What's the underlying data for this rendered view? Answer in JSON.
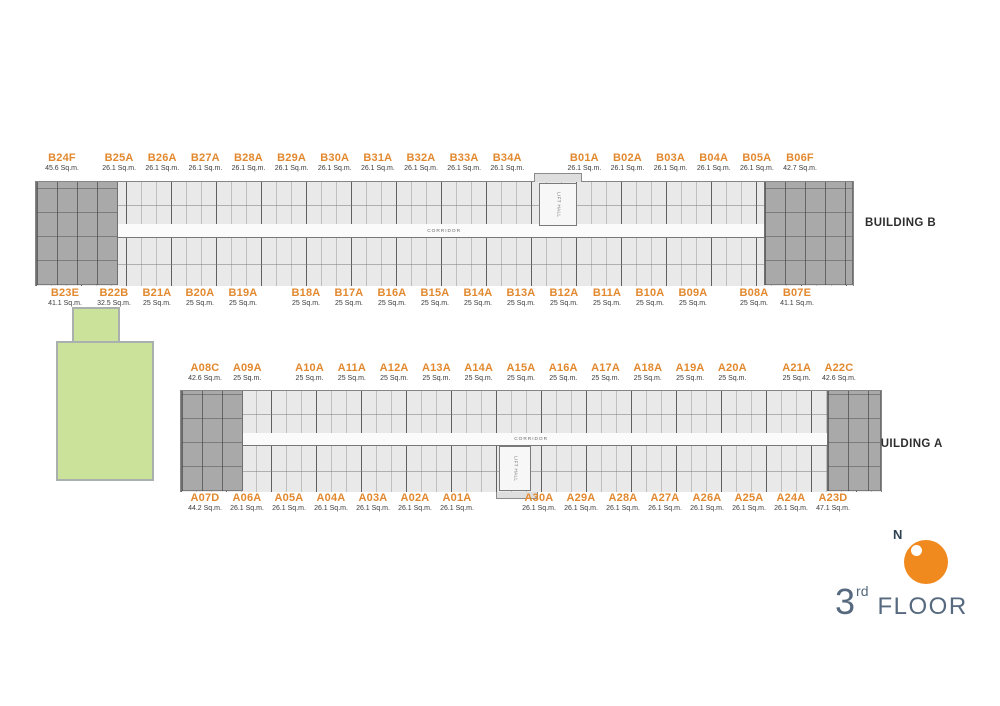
{
  "legend": {
    "north_label": "N",
    "floor_number": "3",
    "floor_ordinal": "rd",
    "floor_word": "FLOOR"
  },
  "colors": {
    "unit_label_orange": "#E2892F",
    "compass_orange": "#F08A1E",
    "floor_title_blue_gray": "#56697E",
    "green_area": "#CBE29B"
  },
  "buildings": [
    {
      "id": "building-b",
      "label": "BUILDING B",
      "corridor_label": "CORRIDOR",
      "lift_label": "LIFT HALL",
      "top_units": [
        {
          "name": "B24F",
          "area": "45.6 Sq.m."
        },
        {
          "name": "B25A",
          "area": "26.1 Sq.m."
        },
        {
          "name": "B26A",
          "area": "26.1 Sq.m."
        },
        {
          "name": "B27A",
          "area": "26.1 Sq.m."
        },
        {
          "name": "B28A",
          "area": "26.1 Sq.m."
        },
        {
          "name": "B29A",
          "area": "26.1 Sq.m."
        },
        {
          "name": "B30A",
          "area": "26.1 Sq.m."
        },
        {
          "name": "B31A",
          "area": "26.1 Sq.m."
        },
        {
          "name": "B32A",
          "area": "26.1 Sq.m."
        },
        {
          "name": "B33A",
          "area": "26.1 Sq.m."
        },
        {
          "name": "B34A",
          "area": "26.1 Sq.m."
        },
        {
          "name": "B01A",
          "area": "26.1 Sq.m."
        },
        {
          "name": "B02A",
          "area": "26.1 Sq.m."
        },
        {
          "name": "B03A",
          "area": "26.1 Sq.m."
        },
        {
          "name": "B04A",
          "area": "26.1 Sq.m."
        },
        {
          "name": "B05A",
          "area": "26.1 Sq.m."
        },
        {
          "name": "B06F",
          "area": "42.7 Sq.m."
        }
      ],
      "bottom_units": [
        {
          "name": "B23E",
          "area": "41.1 Sq.m."
        },
        {
          "name": "B22B",
          "area": "32.5 Sq.m."
        },
        {
          "name": "B21A",
          "area": "25 Sq.m."
        },
        {
          "name": "B20A",
          "area": "25 Sq.m."
        },
        {
          "name": "B19A",
          "area": "25 Sq.m."
        },
        {
          "name": "B18A",
          "area": "25 Sq.m."
        },
        {
          "name": "B17A",
          "area": "25 Sq.m."
        },
        {
          "name": "B16A",
          "area": "25 Sq.m."
        },
        {
          "name": "B15A",
          "area": "25 Sq.m."
        },
        {
          "name": "B14A",
          "area": "25 Sq.m."
        },
        {
          "name": "B13A",
          "area": "25 Sq.m."
        },
        {
          "name": "B12A",
          "area": "25 Sq.m."
        },
        {
          "name": "B11A",
          "area": "25 Sq.m."
        },
        {
          "name": "B10A",
          "area": "25 Sq.m."
        },
        {
          "name": "B09A",
          "area": "25 Sq.m."
        },
        {
          "name": "B08A",
          "area": "25 Sq.m."
        },
        {
          "name": "B07E",
          "area": "41.1 Sq.m."
        }
      ]
    },
    {
      "id": "building-a",
      "label": "BUILDING A",
      "corridor_label": "CORRIDOR",
      "lift_label": "LIFT HALL",
      "top_units": [
        {
          "name": "A08C",
          "area": "42.6 Sq.m."
        },
        {
          "name": "A09A",
          "area": "25 Sq.m."
        },
        {
          "name": "A10A",
          "area": "25 Sq.m."
        },
        {
          "name": "A11A",
          "area": "25 Sq.m."
        },
        {
          "name": "A12A",
          "area": "25 Sq.m."
        },
        {
          "name": "A13A",
          "area": "25 Sq.m."
        },
        {
          "name": "A14A",
          "area": "25 Sq.m."
        },
        {
          "name": "A15A",
          "area": "25 Sq.m."
        },
        {
          "name": "A16A",
          "area": "25 Sq.m."
        },
        {
          "name": "A17A",
          "area": "25 Sq.m."
        },
        {
          "name": "A18A",
          "area": "25 Sq.m."
        },
        {
          "name": "A19A",
          "area": "25 Sq.m."
        },
        {
          "name": "A20A",
          "area": "25 Sq.m."
        },
        {
          "name": "A21A",
          "area": "25 Sq.m."
        },
        {
          "name": "A22C",
          "area": "42.6 Sq.m."
        }
      ],
      "bottom_units": [
        {
          "name": "A07D",
          "area": "44.2 Sq.m."
        },
        {
          "name": "A06A",
          "area": "26.1 Sq.m."
        },
        {
          "name": "A05A",
          "area": "26.1 Sq.m."
        },
        {
          "name": "A04A",
          "area": "26.1 Sq.m."
        },
        {
          "name": "A03A",
          "area": "26.1 Sq.m."
        },
        {
          "name": "A02A",
          "area": "26.1 Sq.m."
        },
        {
          "name": "A01A",
          "area": "26.1 Sq.m."
        },
        {
          "name": "A30A",
          "area": "26.1 Sq.m."
        },
        {
          "name": "A29A",
          "area": "26.1 Sq.m."
        },
        {
          "name": "A28A",
          "area": "26.1 Sq.m."
        },
        {
          "name": "A27A",
          "area": "26.1 Sq.m."
        },
        {
          "name": "A26A",
          "area": "26.1 Sq.m."
        },
        {
          "name": "A25A",
          "area": "26.1 Sq.m."
        },
        {
          "name": "A24A",
          "area": "26.1 Sq.m."
        },
        {
          "name": "A23D",
          "area": "47.1 Sq.m."
        }
      ]
    }
  ]
}
